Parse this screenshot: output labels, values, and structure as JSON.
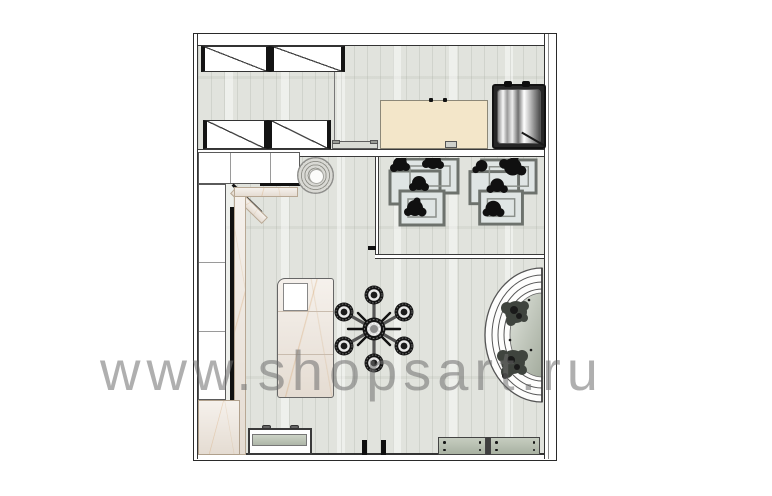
{
  "watermark": {
    "text": "www.shopsart.ru",
    "color": "#9a9a9a"
  },
  "palette": {
    "background": "#ffffff",
    "floor": "#e1e3dd",
    "wall_outline": "#2a2a2a",
    "beige_counter": "#f3e6c9",
    "marble": "#ece3d9",
    "glass_bench": "#aab3a4",
    "table_glass": "#dfe5e4",
    "plant_black": "#101010",
    "podium_plant": "#3f443e",
    "chrome_frame": "#121212"
  },
  "furniture": {
    "wardrobe_units": 4,
    "plant_table_groups": 2,
    "tables_per_group": 3,
    "round_rack_satellites": 6,
    "benches_bottom": 3,
    "entry_posts": 2,
    "podium_rings": 4
  }
}
